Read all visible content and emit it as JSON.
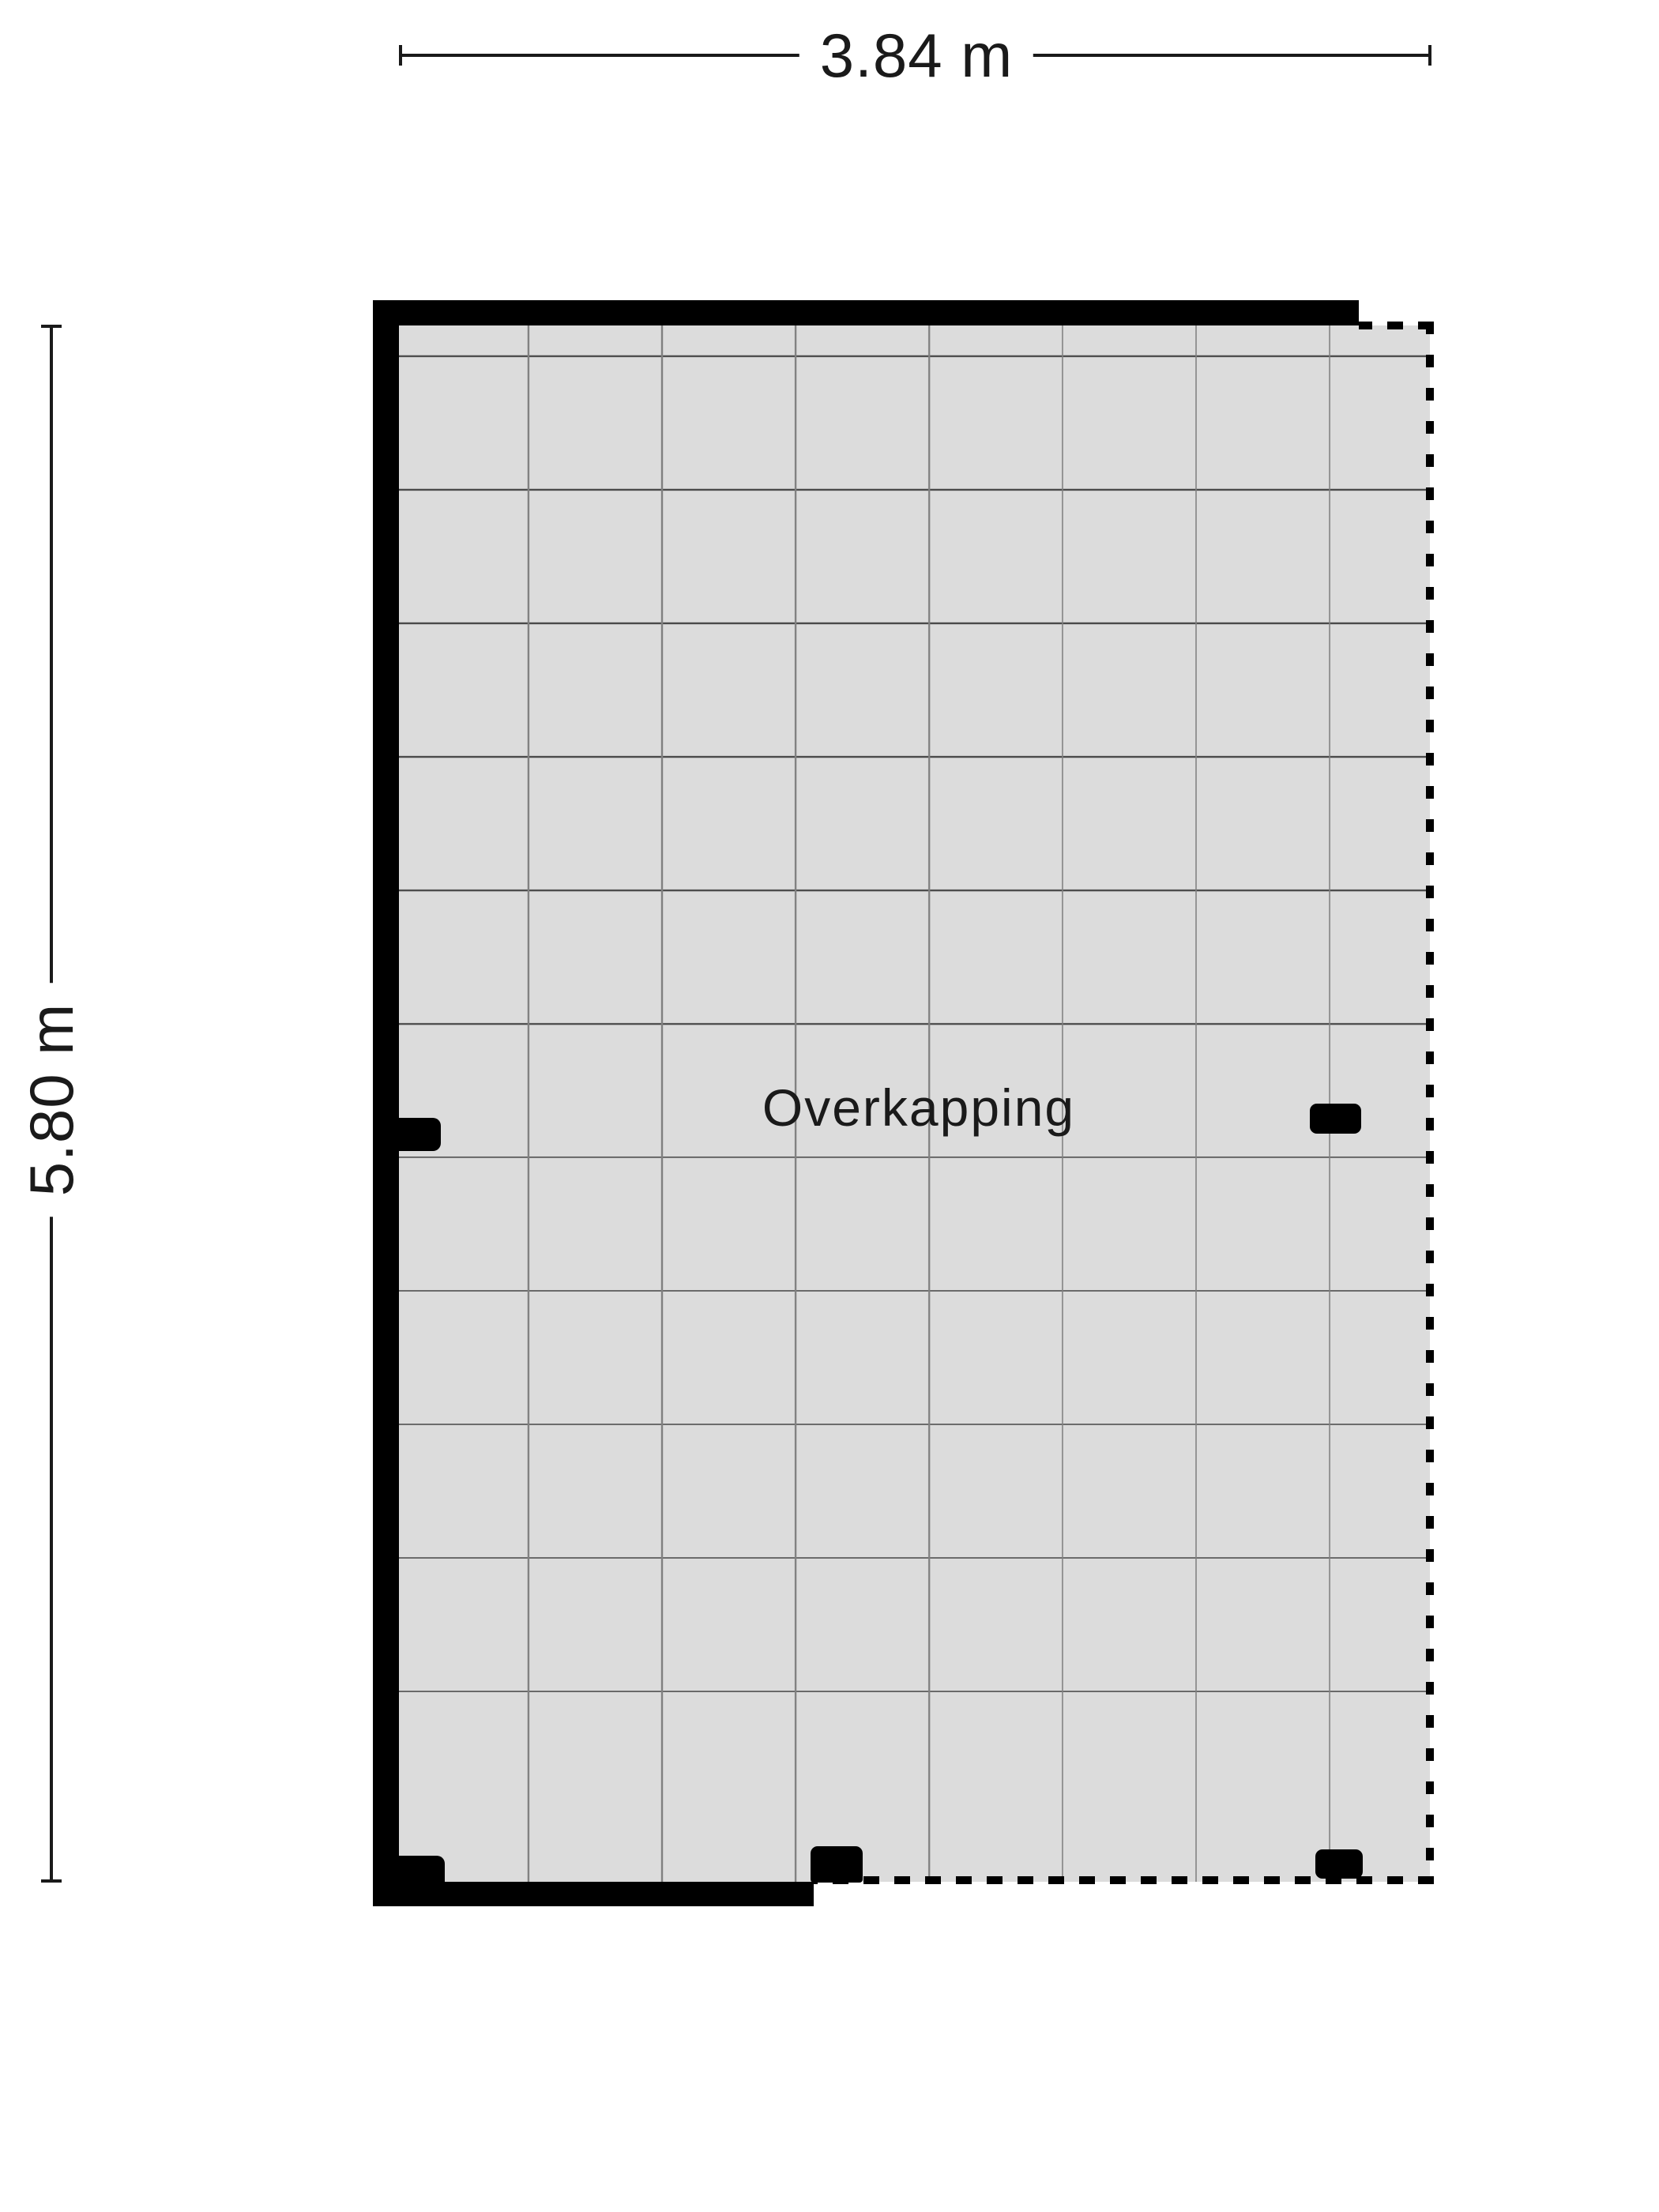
{
  "floorplan": {
    "room_label": "Overkapping",
    "dimensions": {
      "width_label": "3.84 m",
      "height_label": "5.80 m"
    },
    "colors": {
      "wall": "#000000",
      "floor_fill": "#dcdcdc",
      "grid_line_vertical": "#808080",
      "grid_line_horizontal": "#4a4a4a",
      "dimension_line": "#1a1a1a",
      "label_text": "#1a1a1a",
      "background": "#ffffff"
    }
  }
}
